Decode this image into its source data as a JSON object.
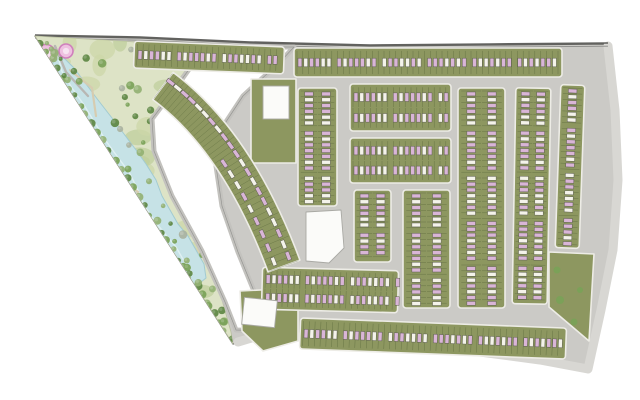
{
  "meta": {
    "title": "Residential community master plan site map",
    "width": 640,
    "height": 400
  },
  "colors": {
    "road_base": "#cbcac6",
    "road_light": "#d8d7d3",
    "boundary": "#62625f",
    "sidewalk": "#edece6",
    "block_green": "#8d9760",
    "plot_line": "#46572c",
    "house_pink": "#d9b5d7",
    "house_white": "#f4f3ea",
    "house_edge": "#5f6052",
    "park_base": "#dde3c6",
    "park_blob1": "#ccd7a8",
    "park_blob2": "#bfcf9c",
    "park_beige": "#d8cfb2",
    "lake_fill": "#c6e2e6",
    "lake_edge": "#a2cbd1",
    "lake_hl": "#eaf6f7",
    "tree_dark": "#5d8743",
    "tree_mid": "#79a258",
    "tree_light": "#93b173",
    "tree_gray": "#a9b29f",
    "garden_pink": "#eec0e0",
    "garden_ring": "#cf7fbc",
    "garden_core": "#f7e3f1",
    "path_beige": "#d6ccb0",
    "path_gray": "#b8b7b3",
    "corridor_fill": "#ffffff",
    "corridor_edge": "#c3c2be",
    "corridor_line": "#969693",
    "building_fill": "#fbfbf9",
    "building_edge": "#a9a9a4"
  },
  "site": {
    "outline": [
      [
        35,
        36
      ],
      [
        140,
        38
      ],
      [
        250,
        43
      ],
      [
        370,
        46
      ],
      [
        490,
        45
      ],
      [
        608,
        44
      ],
      [
        614,
        100
      ],
      [
        618,
        170
      ],
      [
        615,
        240
      ],
      [
        603,
        305
      ],
      [
        588,
        371
      ],
      [
        545,
        362
      ],
      [
        495,
        354
      ],
      [
        440,
        350
      ],
      [
        385,
        346
      ],
      [
        335,
        340
      ],
      [
        295,
        336
      ],
      [
        262,
        334
      ],
      [
        236,
        343
      ],
      [
        233,
        344
      ]
    ]
  },
  "roads": {
    "top_edge": [
      [
        35,
        35
      ],
      [
        140,
        37
      ],
      [
        250,
        42
      ],
      [
        370,
        45
      ],
      [
        490,
        44
      ],
      [
        608,
        43
      ]
    ],
    "perimeter": [
      [
        608,
        46
      ],
      [
        615,
        110
      ],
      [
        618,
        180
      ],
      [
        613,
        250
      ],
      [
        601,
        310
      ],
      [
        588,
        369
      ],
      [
        540,
        360
      ],
      [
        480,
        352
      ],
      [
        415,
        348
      ],
      [
        350,
        342
      ],
      [
        300,
        337
      ],
      [
        265,
        334
      ],
      [
        238,
        342
      ]
    ]
  },
  "park": {
    "outline": [
      [
        35,
        36
      ],
      [
        203,
        46
      ],
      [
        175,
        85
      ],
      [
        150,
        118
      ],
      [
        152,
        150
      ],
      [
        170,
        195
      ],
      [
        200,
        250
      ],
      [
        222,
        300
      ],
      [
        231,
        332
      ],
      [
        233,
        344
      ]
    ],
    "edge_trees": {
      "from": [
        40,
        42
      ],
      "to": [
        231,
        340
      ],
      "count": 34
    },
    "scatter_trees": 46,
    "blob_count": 26,
    "beige_count": 8,
    "seed": 7,
    "lake": {
      "left": [
        [
          54,
          58
        ],
        [
          50,
          75
        ],
        [
          58,
          92
        ],
        [
          70,
          110
        ],
        [
          78,
          128
        ],
        [
          88,
          148
        ],
        [
          100,
          165
        ],
        [
          112,
          180
        ],
        [
          118,
          196
        ],
        [
          126,
          214
        ],
        [
          138,
          230
        ],
        [
          152,
          244
        ],
        [
          164,
          258
        ],
        [
          172,
          272
        ],
        [
          182,
          284
        ]
      ],
      "right": [
        [
          196,
          286
        ],
        [
          206,
          278
        ],
        [
          204,
          264
        ],
        [
          196,
          250
        ],
        [
          188,
          236
        ],
        [
          178,
          224
        ],
        [
          170,
          210
        ],
        [
          162,
          196
        ],
        [
          156,
          180
        ],
        [
          146,
          164
        ],
        [
          136,
          150
        ],
        [
          124,
          134
        ],
        [
          112,
          118
        ],
        [
          98,
          100
        ],
        [
          86,
          84
        ],
        [
          74,
          68
        ],
        [
          62,
          56
        ]
      ]
    },
    "paths_beige": [
      [
        [
          60,
          100
        ],
        [
          88,
          122
        ],
        [
          82,
          150
        ],
        [
          110,
          172
        ],
        [
          138,
          192
        ],
        [
          122,
          220
        ],
        [
          150,
          242
        ],
        [
          168,
          256
        ],
        [
          162,
          272
        ],
        [
          180,
          286
        ]
      ],
      [
        [
          70,
          70
        ],
        [
          92,
          88
        ],
        [
          96,
          116
        ]
      ]
    ],
    "path_gray": [
      [
        55,
        46
      ],
      [
        66,
        72
      ],
      [
        88,
        96
      ]
    ],
    "gardens": [
      {
        "c": [
          46,
          54
        ],
        "r": 9.5
      },
      {
        "c": [
          66,
          51
        ],
        "r": 7
      },
      {
        "c": [
          39,
          70
        ],
        "r": 4.5
      }
    ]
  },
  "corridor": {
    "outline": [
      [
        205,
        47
      ],
      [
        177,
        86
      ],
      [
        152,
        119
      ],
      [
        154,
        151
      ],
      [
        172,
        196
      ],
      [
        202,
        251
      ],
      [
        225,
        302
      ],
      [
        236,
        330
      ],
      [
        266,
        331
      ],
      [
        256,
        296
      ],
      [
        238,
        252
      ],
      [
        222,
        206
      ],
      [
        216,
        166
      ],
      [
        220,
        131
      ],
      [
        243,
        96
      ],
      [
        281,
        61
      ],
      [
        294,
        47
      ]
    ]
  },
  "patches": [
    {
      "name": "green-plot-north",
      "poly": [
        [
          251,
          79
        ],
        [
          296,
          79
        ],
        [
          296,
          163
        ],
        [
          251,
          163
        ]
      ]
    },
    {
      "name": "green-plot-southwest",
      "poly": [
        [
          240,
          291
        ],
        [
          298,
          288
        ],
        [
          298,
          341
        ],
        [
          263,
          351
        ],
        [
          242,
          331
        ]
      ]
    },
    {
      "name": "green-corner-southeast",
      "poly": [
        [
          549,
          252
        ],
        [
          594,
          254
        ],
        [
          589,
          341
        ],
        [
          549,
          307
        ]
      ]
    }
  ],
  "patch_trees": [
    {
      "c": [
        560,
        300
      ],
      "r": 4
    },
    {
      "c": [
        574,
        322
      ],
      "r": 3.5
    },
    {
      "c": [
        557,
        270
      ],
      "r": 3.5
    },
    {
      "c": [
        580,
        290
      ],
      "r": 3
    }
  ],
  "buildings": [
    {
      "name": "white-building-north",
      "rect": [
        263,
        86,
        26,
        33
      ],
      "rot": 0
    },
    {
      "name": "community-facility-plot",
      "poly": [
        [
          306,
          212
        ],
        [
          341,
          210
        ],
        [
          344,
          248
        ],
        [
          329,
          263
        ],
        [
          306,
          261
        ]
      ]
    },
    {
      "name": "white-building-southwest",
      "rect": [
        243,
        299,
        33,
        27
      ],
      "rot": 6
    }
  ],
  "blocks": [
    {
      "name": "top-strip-a",
      "x": 134,
      "y": 44,
      "w": 150,
      "h": 27,
      "rot": 2.2,
      "o": "h",
      "lanes": 1
    },
    {
      "name": "top-strip-b",
      "x": 294,
      "y": 48,
      "w": 268,
      "h": 29,
      "rot": 0,
      "o": "h",
      "lanes": 1
    },
    {
      "name": "right-strip",
      "x": 558,
      "y": 85,
      "w": 24,
      "h": 163,
      "rot": 2,
      "o": "v",
      "lanes": 1
    },
    {
      "name": "narrow-block",
      "x": 298,
      "y": 88,
      "w": 39,
      "h": 118,
      "rot": 0,
      "o": "v",
      "lanes": 2
    },
    {
      "name": "center-block-1",
      "x": 350,
      "y": 84,
      "w": 101,
      "h": 47,
      "rot": 0,
      "o": "h",
      "lanes": 2
    },
    {
      "name": "center-block-2",
      "x": 350,
      "y": 138,
      "w": 101,
      "h": 45,
      "rot": 0,
      "o": "h",
      "lanes": 2
    },
    {
      "name": "v-block-1",
      "x": 354,
      "y": 190,
      "w": 37,
      "h": 72,
      "rot": 0,
      "o": "v",
      "lanes": 2
    },
    {
      "name": "v-block-2",
      "x": 403,
      "y": 190,
      "w": 47,
      "h": 118,
      "rot": 0,
      "o": "v",
      "lanes": 2
    },
    {
      "name": "v-block-3",
      "x": 458,
      "y": 88,
      "w": 47,
      "h": 220,
      "rot": 0,
      "o": "v",
      "lanes": 2
    },
    {
      "name": "v-block-4",
      "x": 514,
      "y": 88,
      "w": 35,
      "h": 216,
      "rot": 1,
      "o": "v",
      "lanes": 2
    },
    {
      "name": "bottom-block",
      "x": 262,
      "y": 269,
      "w": 136,
      "h": 42,
      "rot": 1.5,
      "o": "h",
      "lanes": 2
    },
    {
      "name": "bottom-strip",
      "x": 300,
      "y": 323,
      "w": 266,
      "h": 31,
      "rot": 2.2,
      "o": "h",
      "lanes": 1
    }
  ],
  "fan": {
    "p0": [
      163,
      86
    ],
    "c": [
      238,
      142
    ],
    "p1": [
      284,
      266
    ],
    "width": 34,
    "outer_n": 21,
    "inner_n": 9
  },
  "houses": {
    "step": 5.8,
    "w": 3.9,
    "l": 8.6,
    "group": 7,
    "gap": 4.5,
    "seq": "pwppwwpwpppw"
  }
}
